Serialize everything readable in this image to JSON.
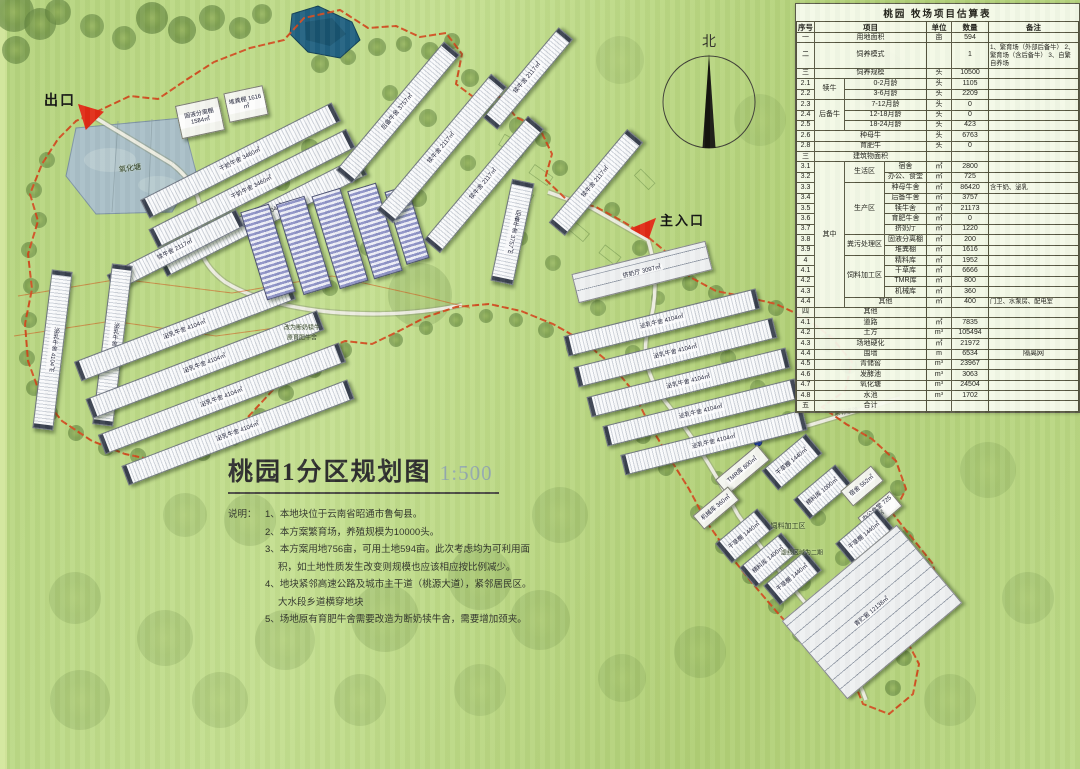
{
  "legend": {
    "exit_label": "出口",
    "entrance_label": "主入口",
    "north_label": "北"
  },
  "title_block": {
    "title": "桃园1分区规划图",
    "scale": "1:500",
    "notes_prefix": "说明：",
    "notes": [
      "1、本地块位于云南省昭通市鲁甸县。",
      "2、本方案繁育场，养殖规模为10000头。",
      "3、本方案用地756亩，可用土地594亩。此次考虑均为可利用面积，如土地性质发生改变则规模也应该相应按比例减少。",
      "4、地块紧邻高速公路及城市主干道（桃源大道），紧邻居民区。大水段乡道横穿地块",
      "5、场地原有育肥牛舍需要改造为断奶犊牛舍，需要增加颈夹。"
    ]
  },
  "map_labels": [
    {
      "t": "氧化塘",
      "x": 130,
      "y": 168,
      "s": 7.5,
      "rot": -8
    },
    {
      "t": "原有道路",
      "x": 846,
      "y": 411,
      "s": 6,
      "rot": -10
    },
    {
      "t": "饲料加工区",
      "x": 788,
      "y": 526,
      "s": 7,
      "rot": 0
    },
    {
      "t": "虚线区域为二期",
      "x": 802,
      "y": 552,
      "s": 6,
      "rot": 0
    },
    {
      "t": "改为断奶犊牛",
      "x": 302,
      "y": 327,
      "s": 6,
      "rot": 0
    },
    {
      "t": "原育肥牛舍",
      "x": 302,
      "y": 337,
      "s": 6,
      "rot": 0
    }
  ],
  "buildings": [
    {
      "l": "干奶牛舍 3460㎡",
      "x": 240,
      "y": 160,
      "w": 215,
      "h": 21,
      "r": -27,
      "t": "barn"
    },
    {
      "l": "干奶牛舍 3460㎡",
      "x": 252,
      "y": 188,
      "w": 222,
      "h": 21,
      "r": -27,
      "t": "barn"
    },
    {
      "l": "泌乳牛舍 4104㎡",
      "x": 262,
      "y": 216,
      "w": 225,
      "h": 21,
      "r": -27,
      "t": "barn"
    },
    {
      "l": "犊牛舍 2117㎡",
      "x": 175,
      "y": 250,
      "w": 145,
      "h": 19,
      "r": -27,
      "t": "barn"
    },
    {
      "l": "固液分离棚 1584㎡",
      "x": 200,
      "y": 118,
      "w": 44,
      "h": 34,
      "r": -12,
      "t": "shed"
    },
    {
      "l": "堆粪棚 1616㎡",
      "x": 246,
      "y": 104,
      "w": 40,
      "h": 30,
      "r": -12,
      "t": "shed"
    },
    {
      "l": "泌乳牛舍 4104㎡",
      "x": 52,
      "y": 350,
      "w": 21,
      "h": 160,
      "r": 7,
      "t": "barn"
    },
    {
      "l": "泌乳牛舍 4104㎡",
      "x": 112,
      "y": 345,
      "w": 21,
      "h": 162,
      "r": 7,
      "t": "barn"
    },
    {
      "l": "泌乳牛舍 4104㎡",
      "x": 185,
      "y": 330,
      "w": 230,
      "h": 21,
      "r": -21,
      "t": "barn"
    },
    {
      "l": "泌乳牛舍 4104㎡",
      "x": 205,
      "y": 364,
      "w": 248,
      "h": 21,
      "r": -21,
      "t": "barn"
    },
    {
      "l": "泌乳牛舍 4104㎡",
      "x": 222,
      "y": 398,
      "w": 258,
      "h": 21,
      "r": -21,
      "t": "barn"
    },
    {
      "l": "泌乳牛舍 4104㎡",
      "x": 238,
      "y": 432,
      "w": 242,
      "h": 21,
      "r": -21,
      "t": "barn"
    },
    {
      "l": "",
      "x": 268,
      "y": 252,
      "w": 30,
      "h": 92,
      "r": -17,
      "t": "hutch"
    },
    {
      "l": "",
      "x": 304,
      "y": 245,
      "w": 30,
      "h": 95,
      "r": -17,
      "t": "hutch"
    },
    {
      "l": "",
      "x": 340,
      "y": 238,
      "w": 30,
      "h": 97,
      "r": -17,
      "t": "hutch"
    },
    {
      "l": "",
      "x": 375,
      "y": 231,
      "w": 30,
      "h": 92,
      "r": -17,
      "t": "hutch"
    },
    {
      "l": "",
      "x": 407,
      "y": 225,
      "w": 24,
      "h": 76,
      "r": -17,
      "t": "hutch"
    },
    {
      "l": "后备牛舍 3757㎡",
      "x": 398,
      "y": 112,
      "w": 168,
      "h": 21,
      "r": -50,
      "t": "barn"
    },
    {
      "l": "犊牛舍 2117㎡",
      "x": 442,
      "y": 148,
      "w": 178,
      "h": 21,
      "r": -50,
      "t": "barn"
    },
    {
      "l": "犊牛舍 2117㎡",
      "x": 484,
      "y": 184,
      "w": 162,
      "h": 21,
      "r": -50,
      "t": "barn"
    },
    {
      "l": "犊牛舍 2117㎡",
      "x": 528,
      "y": 78,
      "w": 118,
      "h": 19,
      "r": -50,
      "t": "barn"
    },
    {
      "l": "后备牛舍 3757㎡",
      "x": 512,
      "y": 232,
      "w": 23,
      "h": 104,
      "r": 12,
      "t": "barn"
    },
    {
      "l": "犊牛舍 2117㎡",
      "x": 596,
      "y": 182,
      "w": 122,
      "h": 21,
      "r": -50,
      "t": "barn"
    },
    {
      "l": "挤奶厅 3097㎡",
      "x": 642,
      "y": 272,
      "w": 138,
      "h": 30,
      "r": -14,
      "t": "slab"
    },
    {
      "l": "泌乳牛舍 4104㎡",
      "x": 662,
      "y": 322,
      "w": 198,
      "h": 21,
      "r": -14,
      "t": "barn"
    },
    {
      "l": "泌乳牛舍 4104㎡",
      "x": 675,
      "y": 352,
      "w": 205,
      "h": 21,
      "r": -14,
      "t": "barn"
    },
    {
      "l": "泌乳牛舍 4104㎡",
      "x": 688,
      "y": 382,
      "w": 205,
      "h": 21,
      "r": -14,
      "t": "barn"
    },
    {
      "l": "泌乳牛舍 4104㎡",
      "x": 701,
      "y": 412,
      "w": 198,
      "h": 21,
      "r": -14,
      "t": "barn"
    },
    {
      "l": "泌乳牛舍 4104㎡",
      "x": 714,
      "y": 442,
      "w": 188,
      "h": 21,
      "r": -14,
      "t": "barn"
    },
    {
      "l": "TMR库 800㎡",
      "x": 742,
      "y": 470,
      "w": 55,
      "h": 20,
      "r": -40,
      "t": "shed"
    },
    {
      "l": "干草棚 1440㎡",
      "x": 792,
      "y": 462,
      "w": 58,
      "h": 26,
      "r": -40,
      "t": "barn"
    },
    {
      "l": "精料库 1000㎡",
      "x": 822,
      "y": 492,
      "w": 55,
      "h": 26,
      "r": -40,
      "t": "barn"
    },
    {
      "l": "宿舍 562㎡",
      "x": 862,
      "y": 486,
      "w": 40,
      "h": 20,
      "r": -40,
      "t": "shed"
    },
    {
      "l": "办公食堂 725㎡",
      "x": 880,
      "y": 512,
      "w": 42,
      "h": 20,
      "r": -40,
      "t": "shed"
    },
    {
      "l": "干草棚 1440㎡",
      "x": 864,
      "y": 536,
      "w": 55,
      "h": 26,
      "r": -40,
      "t": "barn"
    },
    {
      "l": "干草棚 1440㎡",
      "x": 744,
      "y": 536,
      "w": 55,
      "h": 26,
      "r": -40,
      "t": "barn"
    },
    {
      "l": "精料库 1400㎡",
      "x": 768,
      "y": 560,
      "w": 55,
      "h": 26,
      "r": -40,
      "t": "barn"
    },
    {
      "l": "干草棚 1440㎡",
      "x": 792,
      "y": 578,
      "w": 55,
      "h": 26,
      "r": -40,
      "t": "barn"
    },
    {
      "l": "机械库 360㎡",
      "x": 716,
      "y": 508,
      "w": 46,
      "h": 18,
      "r": -40,
      "t": "shed"
    },
    {
      "l": "青贮窖 12138㎡",
      "x": 872,
      "y": 612,
      "w": 150,
      "h": 102,
      "r": -40,
      "t": "slab"
    }
  ],
  "estimate_table": {
    "title": "桃园 牧场项目估算表",
    "rows": [
      [
        {
          "t": "序号",
          "h": 1
        },
        {
          "t": "项目",
          "h": 1,
          "c": 3
        },
        {
          "t": "单位",
          "h": 1
        },
        {
          "t": "数量",
          "h": 1
        },
        {
          "t": "备注",
          "h": 1
        }
      ],
      [
        {
          "t": "一"
        },
        {
          "t": "用地面积",
          "c": 3
        },
        {
          "t": "亩"
        },
        {
          "t": "594"
        },
        {
          "t": ""
        }
      ],
      [
        {
          "t": "二"
        },
        {
          "t": "饲养模式",
          "c": 3
        },
        {
          "t": ""
        },
        {
          "t": "1"
        },
        {
          "t": "1、繁育场（外部后备牛） 2、繁育场（含后备牛） 3、自繁自养场",
          "s": 1
        }
      ],
      [
        {
          "t": "三"
        },
        {
          "t": "饲养规模",
          "c": 3
        },
        {
          "t": "头"
        },
        {
          "t": "10500"
        },
        {
          "t": ""
        }
      ],
      [
        {
          "t": "2.1"
        },
        {
          "t": "犊牛",
          "r": 2
        },
        {
          "t": "0-2月龄",
          "c": 2
        },
        {
          "t": "头"
        },
        {
          "t": "1105"
        },
        {
          "t": ""
        }
      ],
      [
        {
          "t": "2.2"
        },
        {
          "t": "3-6月龄",
          "c": 2
        },
        {
          "t": "头"
        },
        {
          "t": "2209"
        },
        {
          "t": ""
        }
      ],
      [
        {
          "t": "2.3"
        },
        {
          "t": "后备牛",
          "r": 3
        },
        {
          "t": "7-12月龄",
          "c": 2
        },
        {
          "t": "头"
        },
        {
          "t": "0"
        },
        {
          "t": ""
        }
      ],
      [
        {
          "t": "2.4"
        },
        {
          "t": "12-18月龄",
          "c": 2
        },
        {
          "t": "头"
        },
        {
          "t": "0"
        },
        {
          "t": ""
        }
      ],
      [
        {
          "t": "2.5"
        },
        {
          "t": "18-24月龄",
          "c": 2
        },
        {
          "t": "头"
        },
        {
          "t": "423"
        },
        {
          "t": ""
        }
      ],
      [
        {
          "t": "2.6"
        },
        {
          "t": "种母牛",
          "c": 3
        },
        {
          "t": "头"
        },
        {
          "t": "6763"
        },
        {
          "t": ""
        }
      ],
      [
        {
          "t": "2.8"
        },
        {
          "t": "育肥牛",
          "c": 3
        },
        {
          "t": "头"
        },
        {
          "t": "0"
        },
        {
          "t": ""
        }
      ],
      [
        {
          "t": "三"
        },
        {
          "t": "建筑物面积",
          "c": 3
        },
        {
          "t": ""
        },
        {
          "t": ""
        },
        {
          "t": ""
        }
      ],
      [
        {
          "t": "3.1"
        },
        {
          "t": "其中",
          "r": 14
        },
        {
          "t": "生活区",
          "r": 2
        },
        {
          "t": "宿舍"
        },
        {
          "t": "㎡"
        },
        {
          "t": "2800"
        },
        {
          "t": ""
        }
      ],
      [
        {
          "t": "3.2"
        },
        {
          "t": "办公、食堂"
        },
        {
          "t": "㎡"
        },
        {
          "t": "725"
        },
        {
          "t": ""
        }
      ],
      [
        {
          "t": "3.3"
        },
        {
          "t": "生产区",
          "r": 5
        },
        {
          "t": "种母牛舍"
        },
        {
          "t": "㎡"
        },
        {
          "t": "86420"
        },
        {
          "t": "含干奶、泌乳",
          "s": 1
        }
      ],
      [
        {
          "t": "3.4"
        },
        {
          "t": "后备牛舍"
        },
        {
          "t": "㎡"
        },
        {
          "t": "3757"
        },
        {
          "t": ""
        }
      ],
      [
        {
          "t": "3.5"
        },
        {
          "t": "犊牛舍"
        },
        {
          "t": "㎡"
        },
        {
          "t": "21173"
        },
        {
          "t": ""
        }
      ],
      [
        {
          "t": "3.6"
        },
        {
          "t": "育肥牛舍"
        },
        {
          "t": "㎡"
        },
        {
          "t": "0"
        },
        {
          "t": ""
        }
      ],
      [
        {
          "t": "3.7"
        },
        {
          "t": "挤奶厅"
        },
        {
          "t": "㎡"
        },
        {
          "t": "1220"
        },
        {
          "t": ""
        }
      ],
      [
        {
          "t": "3.8"
        },
        {
          "t": "粪污处理区",
          "r": 2
        },
        {
          "t": "固液分离棚"
        },
        {
          "t": "㎡"
        },
        {
          "t": "200"
        },
        {
          "t": ""
        }
      ],
      [
        {
          "t": "3.9"
        },
        {
          "t": "堆粪棚"
        },
        {
          "t": "㎡"
        },
        {
          "t": "1616"
        },
        {
          "t": ""
        }
      ],
      [
        {
          "t": "4"
        },
        {
          "t": "饲料加工区",
          "r": 4
        },
        {
          "t": "精料库"
        },
        {
          "t": "㎡"
        },
        {
          "t": "1952"
        },
        {
          "t": ""
        }
      ],
      [
        {
          "t": "4.1"
        },
        {
          "t": "干草库"
        },
        {
          "t": "㎡"
        },
        {
          "t": "6666"
        },
        {
          "t": ""
        }
      ],
      [
        {
          "t": "4.2"
        },
        {
          "t": "TMR库"
        },
        {
          "t": "㎡"
        },
        {
          "t": "800"
        },
        {
          "t": ""
        }
      ],
      [
        {
          "t": "4.3"
        },
        {
          "t": "机械库"
        },
        {
          "t": "㎡"
        },
        {
          "t": "360"
        },
        {
          "t": ""
        }
      ],
      [
        {
          "t": "4.4"
        },
        {
          "t": "其他",
          "c": 2
        },
        {
          "t": "㎡"
        },
        {
          "t": "400"
        },
        {
          "t": "门卫、水泵房、配电室",
          "s": 1
        }
      ],
      [
        {
          "t": "四"
        },
        {
          "t": "其他",
          "c": 3
        },
        {
          "t": ""
        },
        {
          "t": ""
        },
        {
          "t": ""
        }
      ],
      [
        {
          "t": "4.1"
        },
        {
          "t": "道路",
          "c": 3
        },
        {
          "t": "㎡"
        },
        {
          "t": "7835"
        },
        {
          "t": ""
        }
      ],
      [
        {
          "t": "4.2"
        },
        {
          "t": "土方",
          "c": 3
        },
        {
          "t": "m³"
        },
        {
          "t": "105494"
        },
        {
          "t": ""
        }
      ],
      [
        {
          "t": "4.3"
        },
        {
          "t": "场地硬化",
          "c": 3
        },
        {
          "t": "㎡"
        },
        {
          "t": "21972"
        },
        {
          "t": ""
        }
      ],
      [
        {
          "t": "4.4"
        },
        {
          "t": "围墙",
          "c": 3
        },
        {
          "t": "m"
        },
        {
          "t": "6534"
        },
        {
          "t": "隔离网"
        }
      ],
      [
        {
          "t": "4.5"
        },
        {
          "t": "青储窖",
          "c": 3
        },
        {
          "t": "m³"
        },
        {
          "t": "23967"
        },
        {
          "t": ""
        }
      ],
      [
        {
          "t": "4.6"
        },
        {
          "t": "发酵池",
          "c": 3
        },
        {
          "t": "m³"
        },
        {
          "t": "3063"
        },
        {
          "t": ""
        }
      ],
      [
        {
          "t": "4.7"
        },
        {
          "t": "氧化塘",
          "c": 3
        },
        {
          "t": "m³"
        },
        {
          "t": "24504"
        },
        {
          "t": ""
        }
      ],
      [
        {
          "t": "4.8"
        },
        {
          "t": "水池",
          "c": 3
        },
        {
          "t": "m³"
        },
        {
          "t": "1702"
        },
        {
          "t": ""
        }
      ],
      [
        {
          "t": "五"
        },
        {
          "t": "合计",
          "c": 3
        },
        {
          "t": ""
        },
        {
          "t": ""
        },
        {
          "t": ""
        }
      ]
    ]
  },
  "colors": {
    "boundary": "#d1491d",
    "road": "#ebebdd",
    "pond": "#a9bfc7",
    "reservoir": "#20607f",
    "tree": "#7d9e4b",
    "building": "#f5f6f8",
    "roof_cap": "#39404e",
    "hutch": "#8e93c6",
    "marker_red": "#e02a14"
  }
}
